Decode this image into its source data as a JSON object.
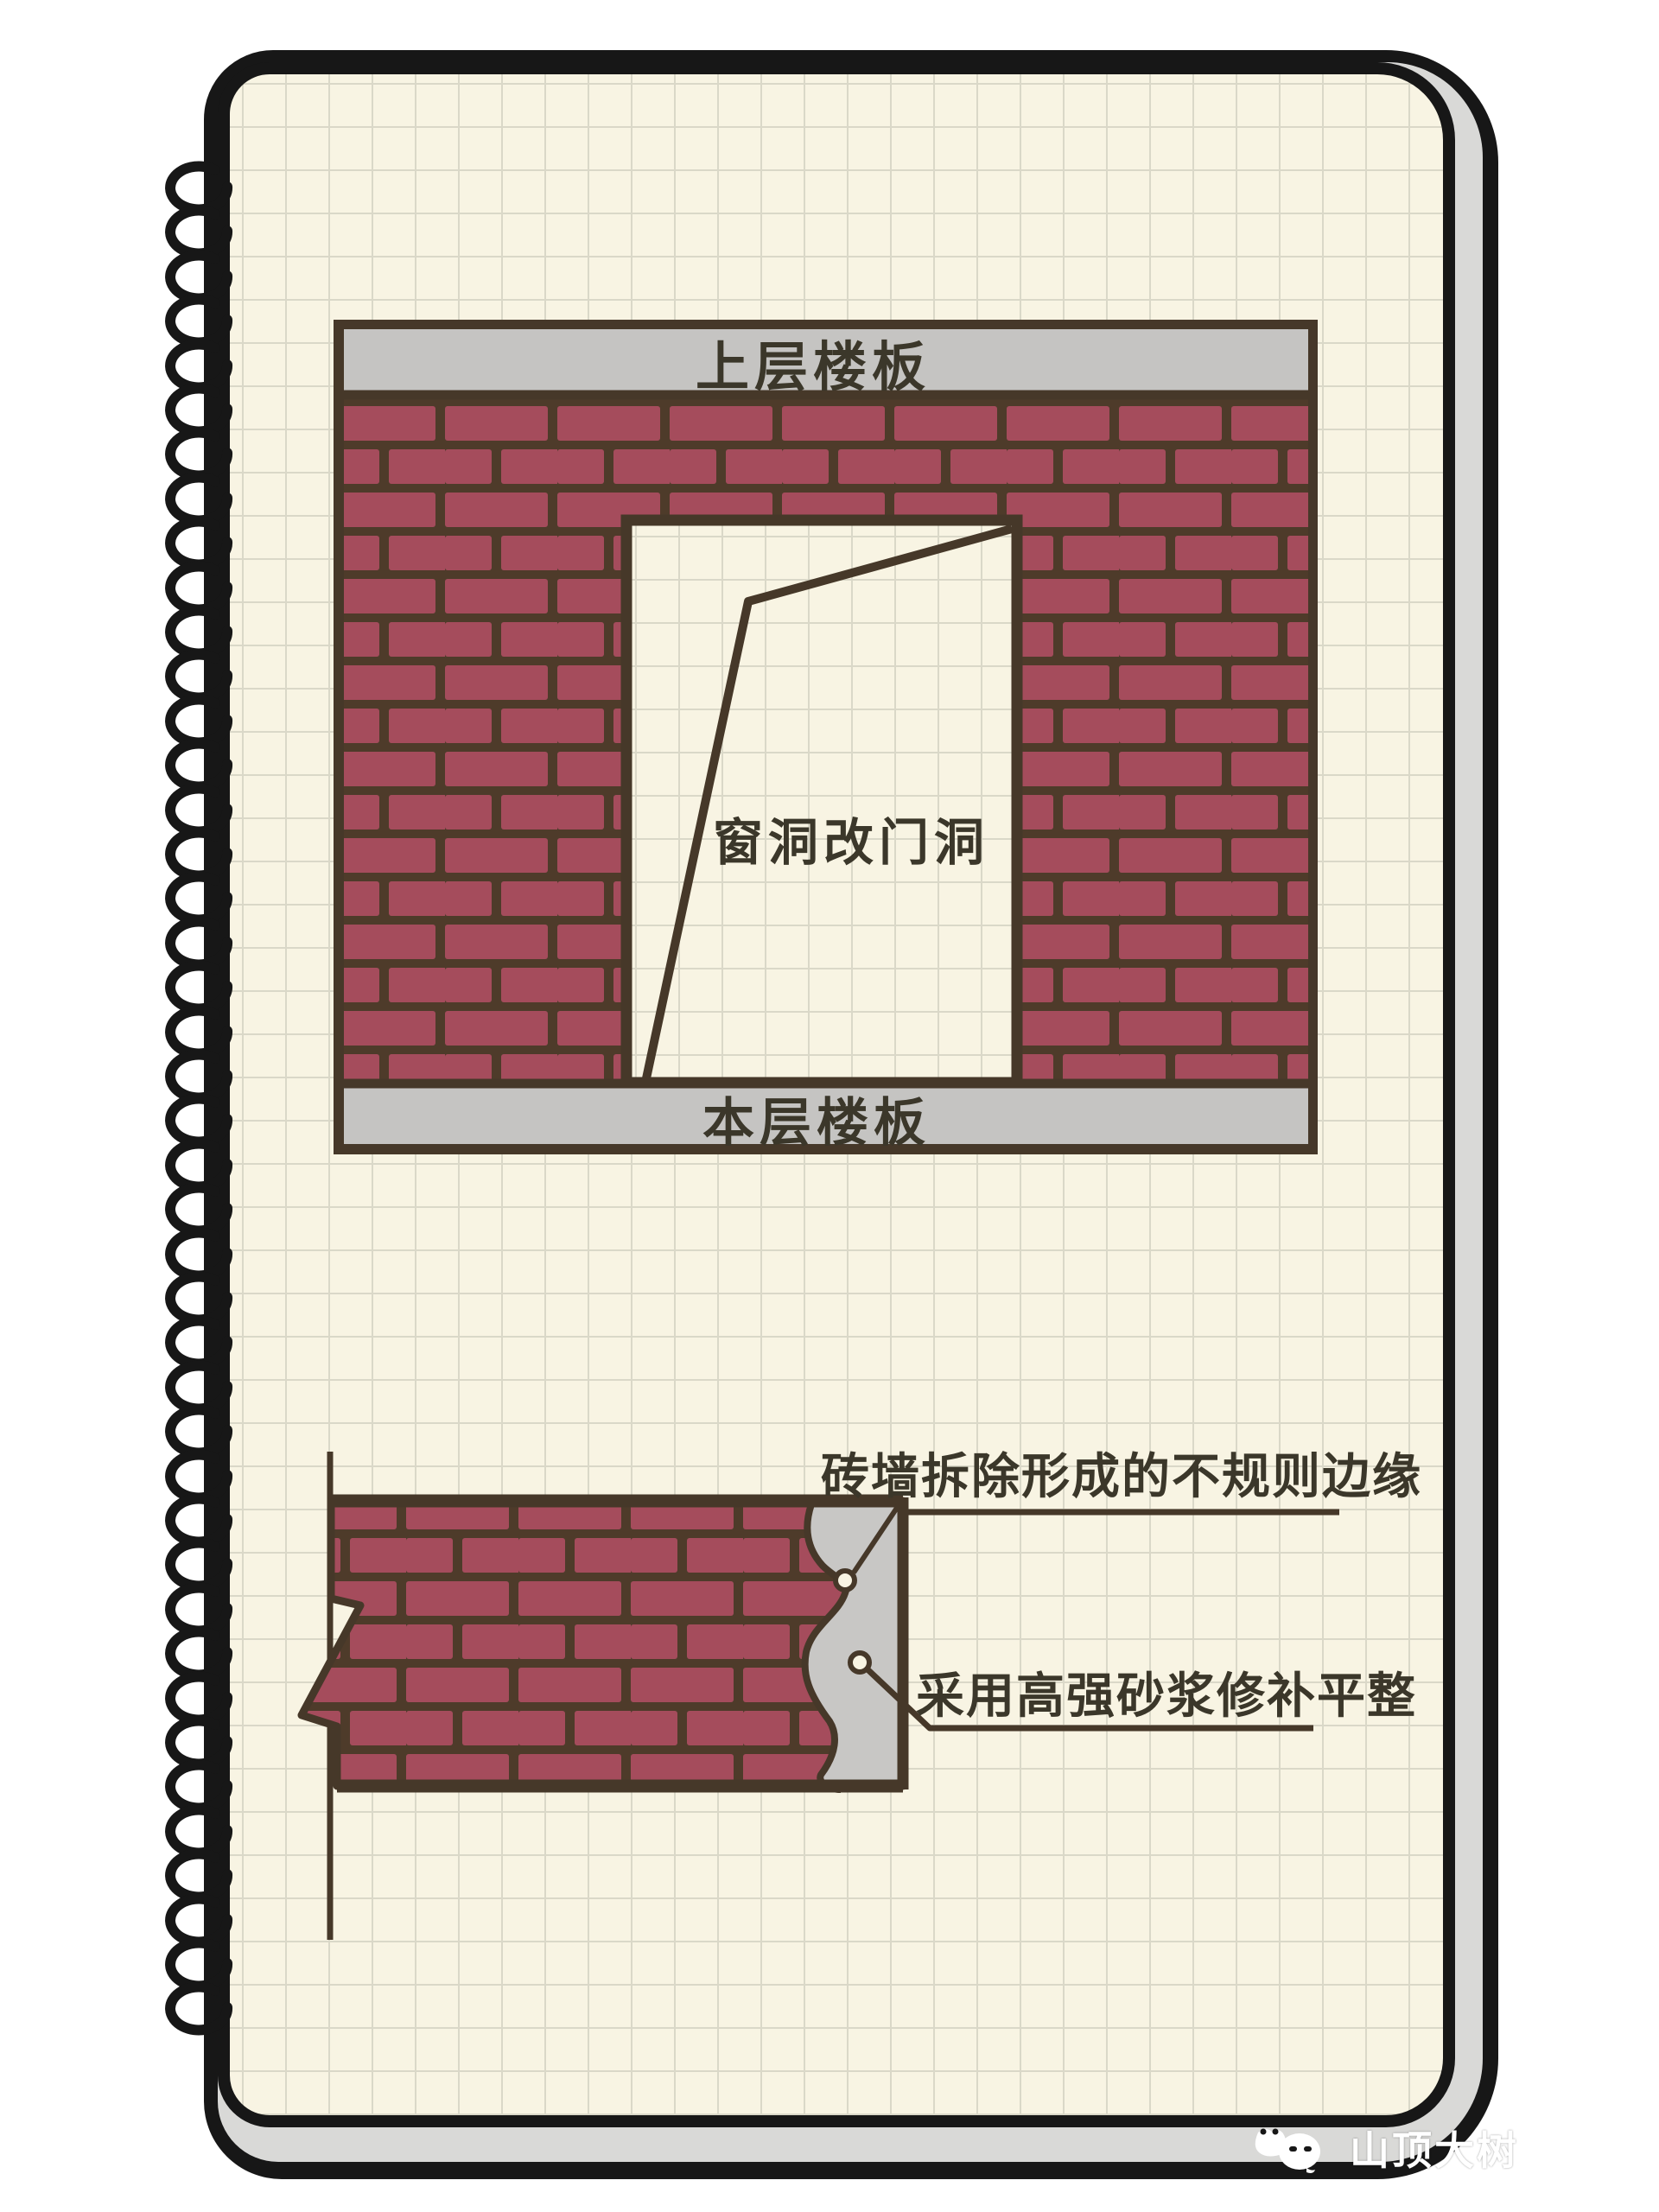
{
  "wall_diagram": {
    "top_slab_label": "上层楼板",
    "bottom_slab_label": "本层楼板",
    "opening_label": "窗洞改门洞"
  },
  "section_diagram": {
    "annotation_irregular_edge": "砖墙拆除形成的不规则边缘",
    "annotation_mortar_repair": "采用高强砂浆修补平整"
  },
  "watermark": {
    "text": "山顶大树"
  },
  "colors": {
    "brick_red": "#a54c5c",
    "mortar_brown": "#4e3b2a",
    "slab_gray": "#c5c4c2",
    "page_cream": "#f8f4e3",
    "grid_line": "#dad8c8",
    "outline_brown": "#463829",
    "ink_black": "#171717",
    "text_dark": "#3b372a",
    "repair_gray": "#c8c7c5"
  }
}
